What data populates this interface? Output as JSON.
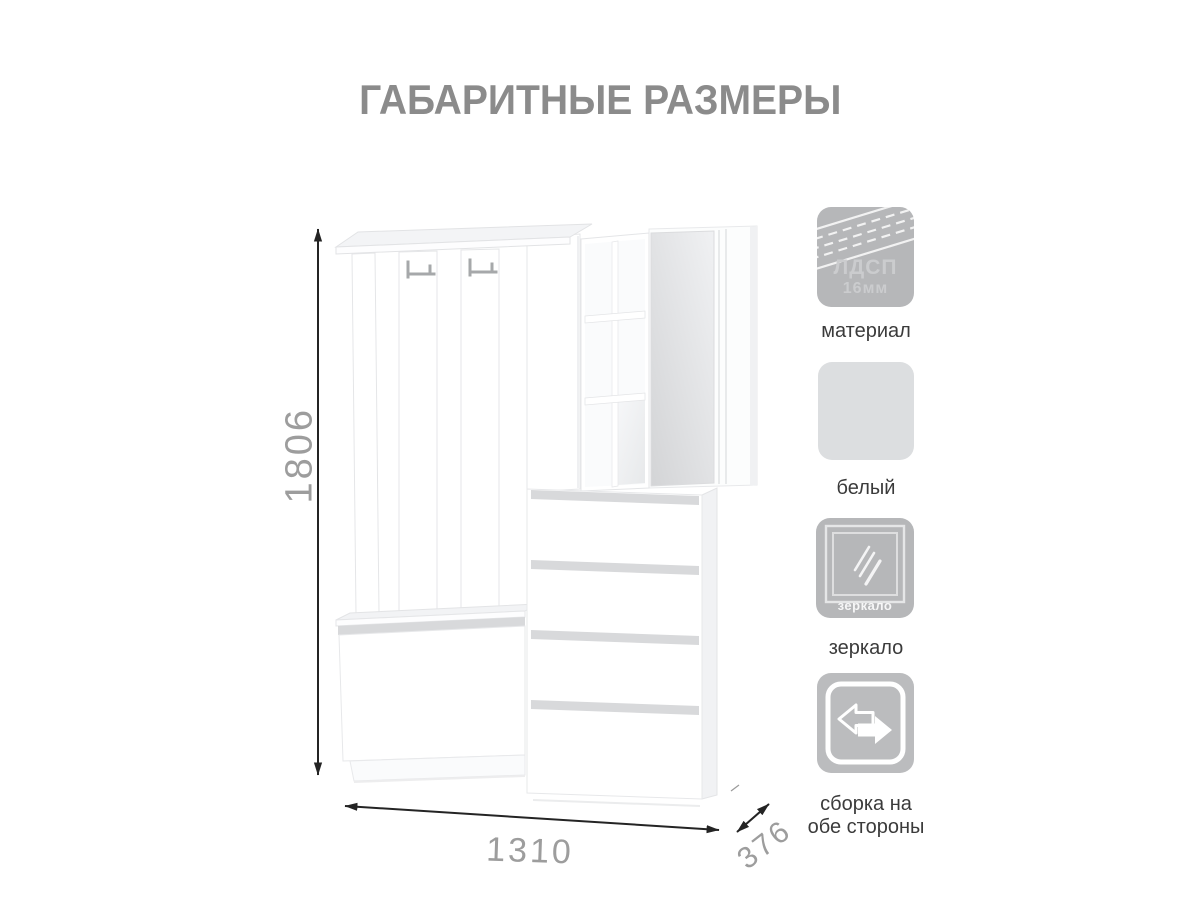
{
  "title": "ГАБАРИТНЫЕ РАЗМЕРЫ",
  "dimensions": {
    "height": "1806",
    "width": "1310",
    "depth": "376"
  },
  "features": [
    {
      "icon": "chipboard-edge-icon",
      "icon_line1": "ЛДСП",
      "icon_line2": "16мм",
      "label": "материал"
    },
    {
      "icon": "white-color-swatch",
      "label": "белый"
    },
    {
      "icon": "mirror-icon",
      "icon_badge": "зеркало",
      "label": "зеркало"
    },
    {
      "icon": "two-way-assembly-icon",
      "label_line1": "сборка на",
      "label_line2": "обе стороны"
    }
  ],
  "colors": {
    "title_gray": "#8b8b8b",
    "dimension_number_gray": "#9d9d9d",
    "dimension_line": "#242424",
    "icon_gray": "#b6b7b9",
    "white_swatch": "#dcdee0",
    "label_text": "#3b3b3b",
    "furniture_groove": "#d8d9db"
  }
}
